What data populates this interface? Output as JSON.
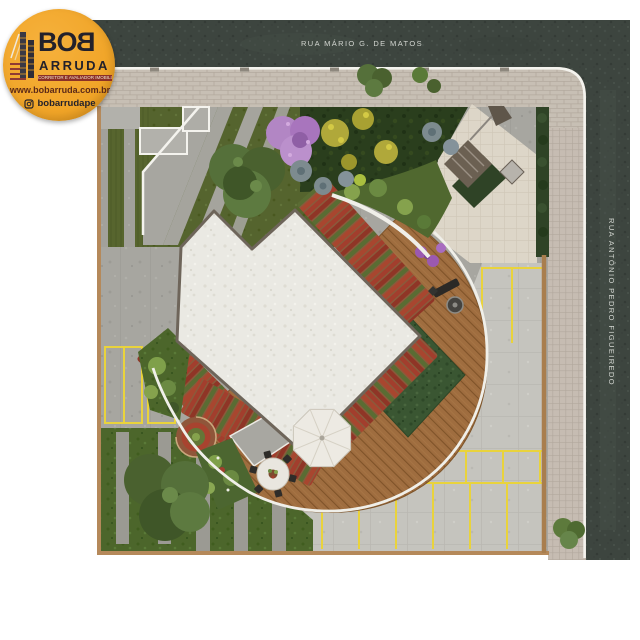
{
  "page": {
    "background": "#FFFFFF"
  },
  "logo": {
    "brand_bo": "BO",
    "brand_b_mirrored": "B",
    "brand_line2": "ARRUDA",
    "tagline": "CORRETOR E AVALIADOR IMOBILIÁRIO",
    "website": "www.bobarruda.com.br",
    "instagram_handle": "bobarrudape",
    "icons": {
      "building": "building-icon",
      "instagram": "instagram-icon"
    },
    "colors": {
      "badge_orange": "#F0A427",
      "text_dark": "#23212B",
      "tagline_bg": "#8C3026",
      "website_text": "#5C2A18",
      "accent_red": "#8F3A33"
    }
  },
  "streets": {
    "top_label": "RUA MÁRIO G. DE MATOS",
    "right_label": "RUA ANTÔNIO PEDRO FIGUEIREDO",
    "label_color": "#D3D6D1"
  },
  "plan": {
    "type": "residential-landscape-site-plan",
    "features": [
      "building-roof",
      "raised-garden-rows",
      "event-lawn",
      "wood-deck",
      "patio-umbrella",
      "outdoor-dining-table",
      "barbecue-grill",
      "deck-bench",
      "parking-stalls",
      "permeable-lawn-parking",
      "entry-plaza",
      "access-ramp",
      "spiral-garden",
      "trees",
      "hedges",
      "sidewalks",
      "streets"
    ],
    "colors": {
      "asphalt": "#3D453F",
      "sidewalk": "#C7BFB4",
      "curb_white": "#F4F3EE",
      "concrete": "#A7A6A0",
      "parking_surface": "#C5C4BE",
      "stall_marking_yellow": "#E9D33C",
      "lawn_green": "#4C662B",
      "event_lawn_green": "#3A5632",
      "deck_wood": "#9F6D3F",
      "garden_row_red": "#A23E2D",
      "building_roof_white": "#EAE9E3",
      "boundary_wall_tan": "#B5895A",
      "flowering_tree_purple": "#B286C4",
      "flowering_tree_yellow": "#B5AD35",
      "shrub_blue_gray": "#7D8B8F"
    }
  }
}
